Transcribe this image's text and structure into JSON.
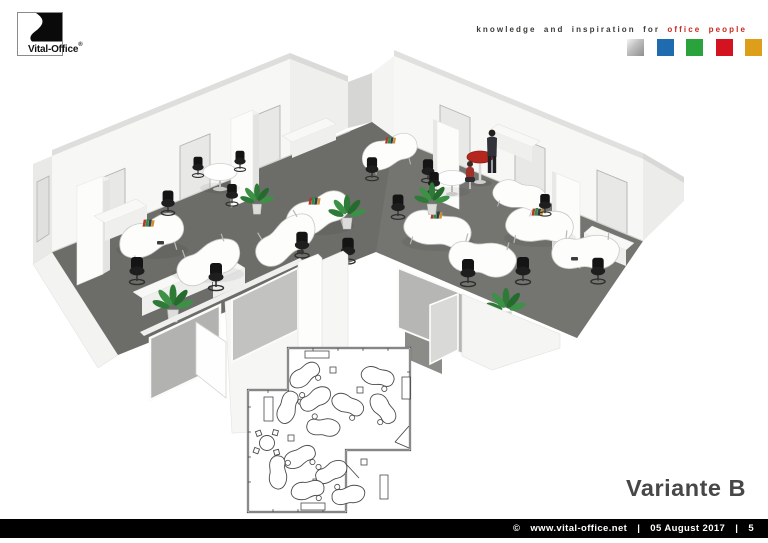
{
  "header": {
    "logo": {
      "text": "Vital-Office",
      "registered": "®"
    },
    "tagline": {
      "prefix": "knowledge and inspiration for",
      "highlight": "office people"
    },
    "palette": [
      {
        "name": "silver-square",
        "color": "#b5b5b5"
      },
      {
        "name": "blue-square",
        "color": "#1e6bb0"
      },
      {
        "name": "green-square",
        "color": "#2ba33c"
      },
      {
        "name": "red-square",
        "color": "#d31420"
      },
      {
        "name": "gold-square",
        "color": "#dd9f19"
      }
    ]
  },
  "main": {
    "variant_label": "Variante B"
  },
  "footer": {
    "copyright": "©",
    "website": "www.vital-office.net",
    "separator": "|",
    "date": "05 August 2017",
    "page": "5"
  },
  "colors": {
    "carpet": "#6c6c69",
    "wall": "#f7f7f6",
    "accent_red": "#b5271e",
    "footer_bg": "#000000"
  }
}
